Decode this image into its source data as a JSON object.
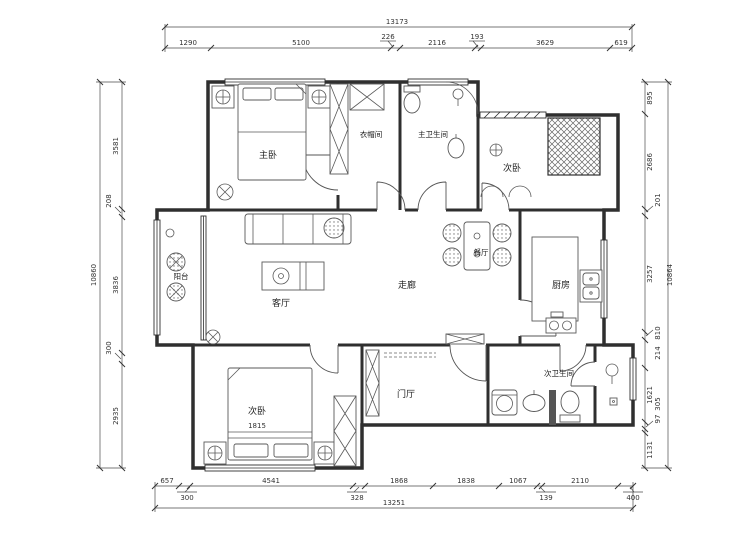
{
  "meta": {
    "drawing_type": "architectural-floor-plan"
  },
  "rooms": {
    "master_bedroom": "主卧",
    "cloakroom": "衣帽间",
    "master_bathroom": "主卫生间",
    "bedroom_top_right": "次卧",
    "balcony": "阳台",
    "living_room": "客厅",
    "corridor": "走廊",
    "dining_room": "餐厅",
    "kitchen": "厨房",
    "foyer": "门厅",
    "second_bathroom": "次卫生间",
    "bedroom_bottom": "次卧",
    "bed_width": "1815"
  },
  "dims": {
    "top": {
      "total": "13173",
      "s0": "1290",
      "s1": "5100",
      "s2": "226",
      "s3": "2116",
      "s4": "193",
      "s5": "3629",
      "s6": "619"
    },
    "bottom": {
      "total": "13251",
      "s0": "657",
      "s1": "300",
      "s2": "4541",
      "s3": "328",
      "s4": "1868",
      "s5": "1838",
      "s6": "1067",
      "s7": "139",
      "s8": "2110",
      "s9": "400"
    },
    "left": {
      "total": "10860",
      "s0": "3581",
      "s1": "208",
      "s2": "3836",
      "s3": "300",
      "s4": "2935"
    },
    "right": {
      "total": "10864",
      "s0": "895",
      "s1": "2686",
      "s2": "201",
      "s3": "3257",
      "s4": "810",
      "s5": "214",
      "s6": "1621",
      "s7": "305",
      "s8": "97",
      "s9": "1131"
    }
  },
  "colors": {
    "wall": "#2f2f2f",
    "furniture": "#5a5a5a",
    "dimension": "#444444",
    "text": "#222222",
    "background": "#ffffff"
  }
}
